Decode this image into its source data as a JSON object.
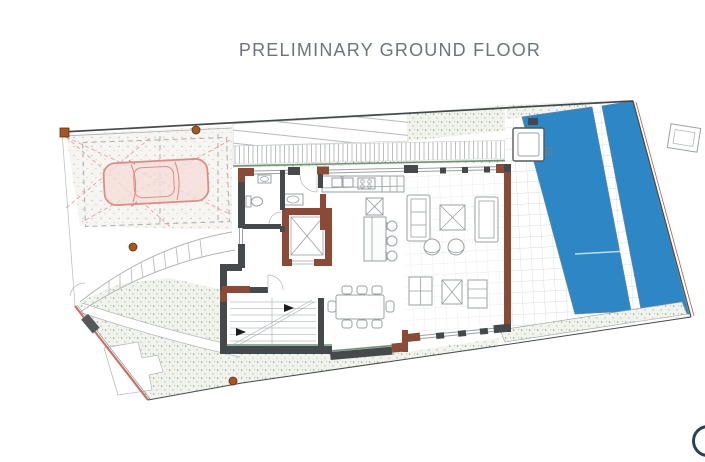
{
  "header": {
    "title": "PRELIMINARY GROUND FLOOR"
  },
  "branding": {
    "logo_shape": "partial-circle-cropped-at-right-edge"
  },
  "plan_features": [
    "carport-with-car-symbol",
    "driveway-dashed-sight-lines",
    "stepped-entrance-walkway",
    "entry-door-swing",
    "wc-toilet-and-sink",
    "elevator-shaft",
    "kitchen-counter-sink-cooktop",
    "kitchen-island-with-three-bar-stools",
    "open-plan-living-room",
    "two-sofas-two-coffee-tables",
    "two-round-armchairs",
    "dining-table-for-eight",
    "internal-staircase-with-direction-arrows",
    "garden-with-curved-exterior-steps",
    "swimming-pool",
    "pool-lap-channel",
    "spa-tub",
    "tiled-pool-deck",
    "planting-strips",
    "site-boundary",
    "gate-at-lower-left",
    "column-markers"
  ],
  "colors": {
    "canvas": "#ffffff",
    "title_gray": "#6d757c",
    "boundary_dark": "#45494c",
    "boundary_red": "#c96f66",
    "wall_dark": "#45494c",
    "wall_brown": "#8a4a36",
    "hedge_green": "#6f9178",
    "stipple_bg": "#f1f3ec",
    "stip_dot1": "#93a893",
    "stip_dot2": "#aebfa9",
    "hatch_gray": "#a9aeb1",
    "line_gray": "#b0b5b8",
    "furniture_gray": "#9aa0a3",
    "floor_grid": "#e3e6e8",
    "deck_grid": "#ccd1d4",
    "pool_blue": "#2d87c5",
    "pool_edge": "#5b87a6",
    "car_pink": "#d98f88",
    "car_fill": "#f5ddd9",
    "column_orange": "#a9561e",
    "cabinet_fill": "#fbfcfc",
    "arrow_black": "#1c1c1c",
    "logo_navy": "#2e3f5c"
  }
}
